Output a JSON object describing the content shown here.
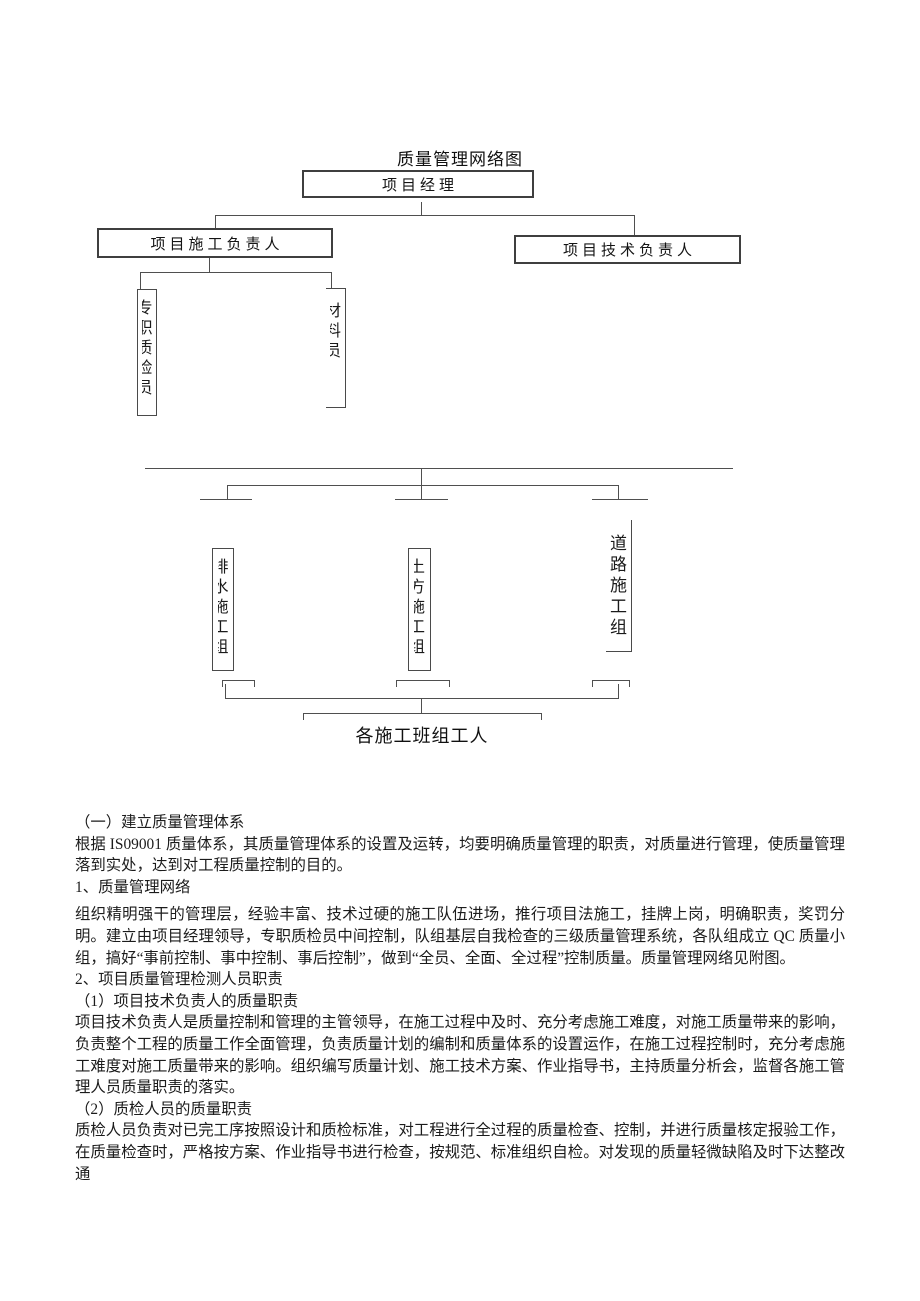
{
  "page": {
    "background": "#ffffff",
    "line_color": "#4f4f4f"
  },
  "chart": {
    "title": "质量管理网络图",
    "nodes": {
      "project_manager": "项目经理",
      "construction_lead": "项目施工负责人",
      "technical_lead": "项目技术负责人",
      "qc_inspector": "专职质检员",
      "material_clerk": "材料员",
      "drainage_group": "排水施工组",
      "earthwork_group": "土方施工组",
      "road_group": "道路施工组",
      "workers": "各施工班组工人"
    }
  },
  "document": {
    "sections": [
      {
        "type": "heading",
        "text": "（一）建立质量管理体系"
      },
      {
        "type": "paragraph",
        "text": "根据 IS09001 质量体系，其质量管理体系的设置及运转，均要明确质量管理的职责，对质量进行管理，使质量管理落到实处，达到对工程质量控制的目的。"
      },
      {
        "type": "heading",
        "text": "1、质量管理网络"
      },
      {
        "type": "paragraph",
        "text": "组织精明强干的管理层，经验丰富、技术过硬的施工队伍进场，推行项目法施工，挂牌上岗，明确职责，奖罚分明。建立由项目经理领导，专职质检员中间控制，队组基层自我检查的三级质量管理系统，各队组成立 QC 质量小组，搞好“事前控制、事中控制、事后控制”，做到“全员、全面、全过程”控制质量。质量管理网络见附图。"
      },
      {
        "type": "heading",
        "text": "2、项目质量管理检测人员职责"
      },
      {
        "type": "heading",
        "text": "（1）项目技术负责人的质量职责"
      },
      {
        "type": "paragraph",
        "text": "项目技术负责人是质量控制和管理的主管领导，在施工过程中及时、充分考虑施工难度，对施工质量带来的影响，负责整个工程的质量工作全面管理，负责质量计划的编制和质量体系的设置运作，在施工过程控制时，充分考虑施工难度对施工质量带来的影响。组织编写质量计划、施工技术方案、作业指导书，主持质量分析会，监督各施工管理人员质量职责的落实。"
      },
      {
        "type": "heading",
        "text": "（2）质检人员的质量职责"
      },
      {
        "type": "paragraph",
        "text": "质检人员负责对已完工序按照设计和质检标准，对工程进行全过程的质量检查、控制，并进行质量核定报验工作，在质量检查时，严格按方案、作业指导书进行检查，按规范、标准组织自检。对发现的质量轻微缺陷及时下达整改通"
      }
    ]
  }
}
